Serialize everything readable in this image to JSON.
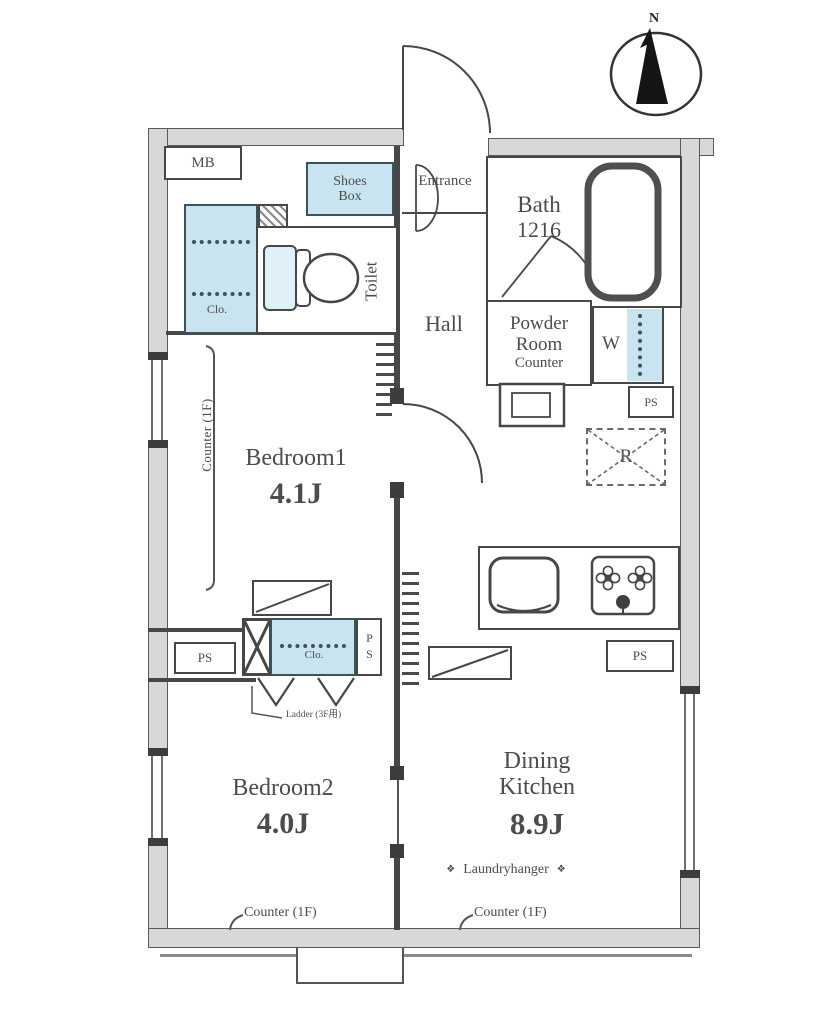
{
  "colors": {
    "wall_fill": "#d8d8d8",
    "wall_edge": "#5a5a5a",
    "line": "#474747",
    "closet_fill": "#c9e4f1",
    "closet_edge": "#3c525c",
    "text": "#4c4c4c"
  },
  "compass": {
    "north_label": "N"
  },
  "rooms": {
    "meter_box": {
      "label": "MB"
    },
    "shoes_box": {
      "label": "Shoes Box"
    },
    "entrance": {
      "label": "Entrance"
    },
    "toilet": {
      "label": "Toilet"
    },
    "closet1": {
      "label": "Clo."
    },
    "hall": {
      "label": "Hall"
    },
    "bath": {
      "label": "Bath",
      "size": "1216"
    },
    "powder_room": {
      "line1": "Powder",
      "line2": "Room",
      "line3": "Counter"
    },
    "washing_machine": {
      "label": "W"
    },
    "refrigerator": {
      "label": "R"
    },
    "bedroom1": {
      "label": "Bedroom1",
      "area": "4.1J"
    },
    "closet2": {
      "label": "Clo."
    },
    "bedroom2": {
      "label": "Bedroom2",
      "area": "4.0J"
    },
    "dining_kitchen": {
      "line1": "Dining",
      "line2": "Kitchen",
      "area": "8.9J"
    }
  },
  "annotations": {
    "pipe_space": "PS",
    "counter_1f_left": "Counter (1F)",
    "counter_1f_bottom_left": "Counter (1F)",
    "counter_1f_bottom_right": "Counter (1F)",
    "laundry_hanger": "Laundryhanger",
    "laundry_mark": "❖",
    "ladder": "Ladder (3F用)"
  }
}
